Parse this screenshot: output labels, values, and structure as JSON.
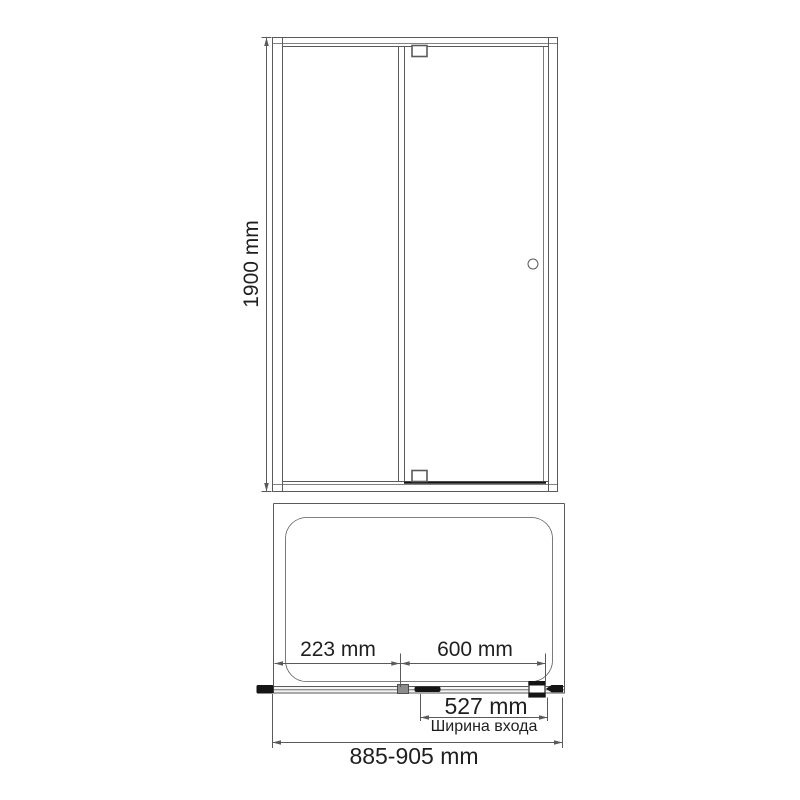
{
  "diagram": {
    "front_view": {
      "height": "1900 mm"
    },
    "plan_view": {
      "fixed_panel_width": "223 mm",
      "door_width": "600 mm",
      "entry_width": "527 mm",
      "entry_width_caption": "Ширина входа",
      "overall_width": "885-905 mm"
    },
    "colors": {
      "line": "#5a5a5a",
      "text": "#1f1f1f",
      "solid": "#151515",
      "background": "#ffffff"
    }
  }
}
